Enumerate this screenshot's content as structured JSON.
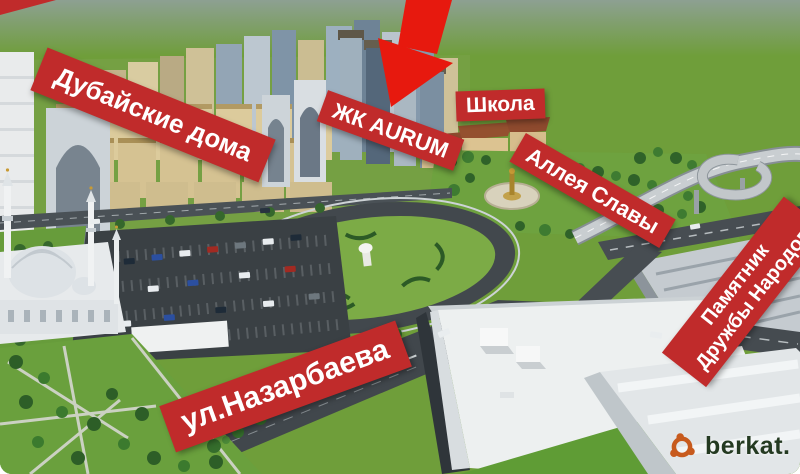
{
  "labels": {
    "dubai_houses": {
      "text": "Дубайские дома"
    },
    "aurum": {
      "text": "ЖК AURUM"
    },
    "school": {
      "text": "Школа"
    },
    "alley_of_glory": {
      "text": "Аллея Славы"
    },
    "monument": {
      "line1": "Памятник",
      "line2": "Дружбы Народов"
    },
    "street": {
      "text": "ул.Назарбаева"
    }
  },
  "watermark": {
    "text": "berkat."
  },
  "colors": {
    "banner_red": "#c02b2b",
    "arrow_red": "#e7190e",
    "watermark_orange": "#c75a1d",
    "watermark_text": "#243a21"
  }
}
